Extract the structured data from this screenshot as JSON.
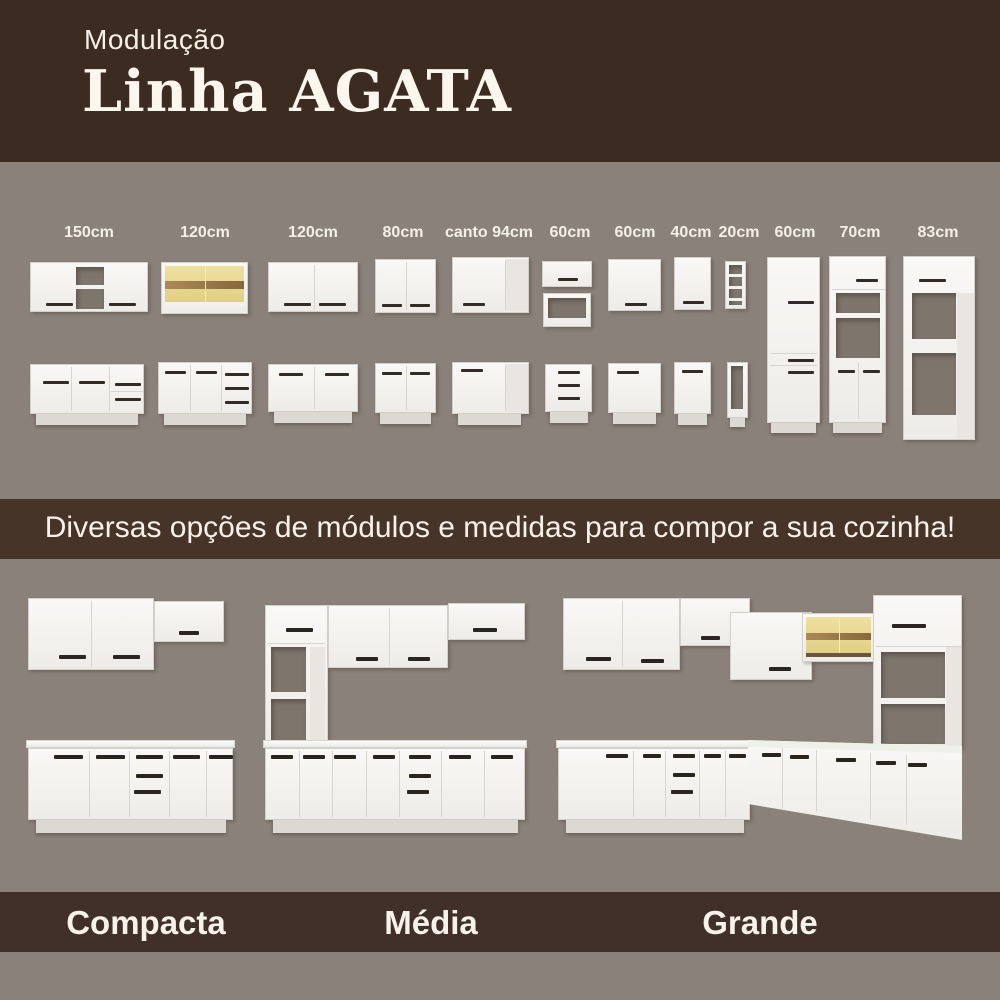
{
  "header": {
    "kicker": "Modulação",
    "title": "Linha AGATA"
  },
  "modules": {
    "items": [
      {
        "label": "150cm"
      },
      {
        "label": "120cm"
      },
      {
        "label": "120cm"
      },
      {
        "label": "80cm"
      },
      {
        "label": "canto 94cm"
      },
      {
        "label": "60cm"
      },
      {
        "label": "60cm"
      },
      {
        "label": "40cm"
      },
      {
        "label": "20cm"
      },
      {
        "label": "60cm"
      },
      {
        "label": "70cm"
      },
      {
        "label": "83cm"
      }
    ]
  },
  "banner": {
    "text": "Diversas opções de módulos e medidas para compor a sua cozinha!"
  },
  "kitchens": {
    "items": [
      {
        "label": "Compacta"
      },
      {
        "label": "Média"
      },
      {
        "label": "Grande"
      }
    ]
  },
  "colors": {
    "header_bg": "#3c2b20",
    "panel_bg": "#8a817a",
    "banner_bg": "#463428",
    "footer_bg": "#41302a",
    "text_light": "#f7f2ea",
    "cabinet_white": "#f5f4f1",
    "wood_tone": "#e7d794",
    "handle_dark": "#332c26"
  }
}
